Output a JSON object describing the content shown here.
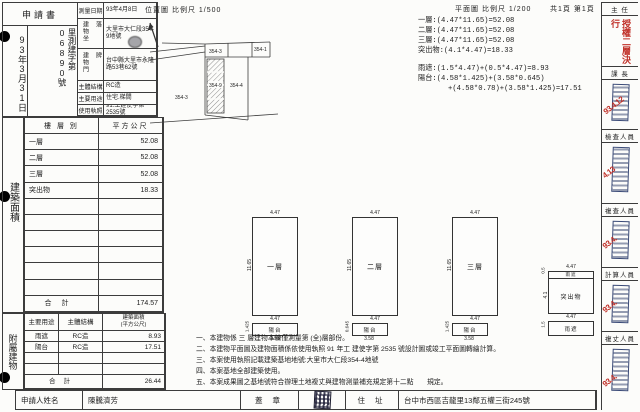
{
  "receipt": {
    "doc_type": "申請書",
    "date": "93年3月31日",
    "number": "里測建字第06890號"
  },
  "survey": {
    "rows": [
      {
        "label": "測量日期",
        "value": "93年4月8日"
      },
      {
        "label": "建物坐落",
        "value": "大里市大仁段354-9地號"
      },
      {
        "label": "建物門牌",
        "value": "台中縣大里市永隆路53巷62號"
      },
      {
        "label": "主體結構",
        "value": "RC造"
      },
      {
        "label": "主要用途",
        "value": "住宅.梯間"
      },
      {
        "label": "使用執照",
        "value": "91.工建使字第2535號"
      }
    ]
  },
  "area": {
    "section": "建築面積",
    "col_floor": "樓 層 別",
    "col_sqm": "平方公尺",
    "rows": [
      {
        "floor": "一層",
        "sqm": "52.08"
      },
      {
        "floor": "二層",
        "sqm": "52.08"
      },
      {
        "floor": "三層",
        "sqm": "52.08"
      },
      {
        "floor": "突出物",
        "sqm": "18.33"
      }
    ],
    "total_label": "合計",
    "total": "174.57"
  },
  "annex": {
    "section": "附屬建物",
    "col_use": "主要用途",
    "col_struct": "主體結構",
    "col_area1": "建築面積",
    "col_area2": "(平方公尺)",
    "rows": [
      {
        "use": "雨遮",
        "struct": "RC造",
        "area": "8.93"
      },
      {
        "use": "陽台",
        "struct": "RC造",
        "area": "17.51"
      }
    ],
    "total_label": "合計",
    "total": "26.44"
  },
  "applicant": {
    "name_label": "申請人姓名",
    "name": "陳騰濟芳",
    "seal_label": "蓋 章",
    "addr_label": "住 址",
    "address": "台中市西區吉龍里13鄰五權三街245號"
  },
  "site_plan": {
    "title": "位置圖",
    "scale": "比例尺 1/500",
    "parcel_topleft": "354-3",
    "parcel_topright": "354-1",
    "parcel_subject": "354-9",
    "parcel_right": "354-4",
    "parcel_left": "354-3"
  },
  "floor_plan_header": {
    "title": "平面圖",
    "scale": "比例尺 1/200",
    "pages": "共1頁 第1頁"
  },
  "calc": {
    "lines": [
      "一層:(4.47*11.65)=52.08",
      "二層:(4.47*11.65)=52.08",
      "三層:(4.47*11.65)=52.08",
      "突出物:(4.1*4.47)=18.33",
      "雨遮:(1.5*4.47)+(0.5*4.47)=8.93",
      "陽台:(4.58*1.425)+(3.58*0.645)",
      "+(4.58*0.78)+(3.58*1.425)=17.51"
    ]
  },
  "plans": [
    {
      "label": "一層",
      "top": "4.47",
      "side": "11.65",
      "bottom": "4.47",
      "annex_label": "陽台",
      "annex_w": "4.58",
      "annex_d": "1.425"
    },
    {
      "label": "二層",
      "top": "4.47",
      "side": "11.65",
      "bottom": "4.47",
      "annex_label": "陽台",
      "annex_w": "3.58",
      "annex_d": "0.645"
    },
    {
      "label": "三層",
      "top": "4.47",
      "side": "11.65",
      "bottom": "4.47",
      "annex_label": "陽台",
      "annex_w": "3.58",
      "annex_d": "1.425"
    },
    {
      "label": "突出物",
      "top": "4.47",
      "side": "4.1",
      "mid": "4.47",
      "top_annex": "雨遮",
      "top_d": "0.5",
      "bottom_annex": "雨遮",
      "bottom_d": "1.5"
    }
  ],
  "notes": [
    "一、本建物係 三 層建物本棟僅測量第 (全)層部份。",
    "二、本建物平面圖及建物面積係依使用執照 91 年工 建使字第 2535 號設計圖或竣工平面圖轉繪計算。",
    "三、本案使用執照記載建築基地地號:大里市大仁段354-4地號",
    "四、本案基地全部建築使用。",
    "五、本案成果圖之基地號符合辦理土地複丈與建物測量補充規定第十二點　　規定。"
  ],
  "approval": {
    "boxes": [
      {
        "role": "主 任",
        "note": "授權二層決行",
        "date": ""
      },
      {
        "role": "課 長",
        "date": "93.4.12"
      },
      {
        "role": "檢查人員",
        "date": "4.13"
      },
      {
        "role": "複查人員",
        "date": "93.4."
      },
      {
        "role": "計算人員",
        "date": "93.4."
      },
      {
        "role": "複丈人員",
        "date": "93.4."
      }
    ]
  }
}
